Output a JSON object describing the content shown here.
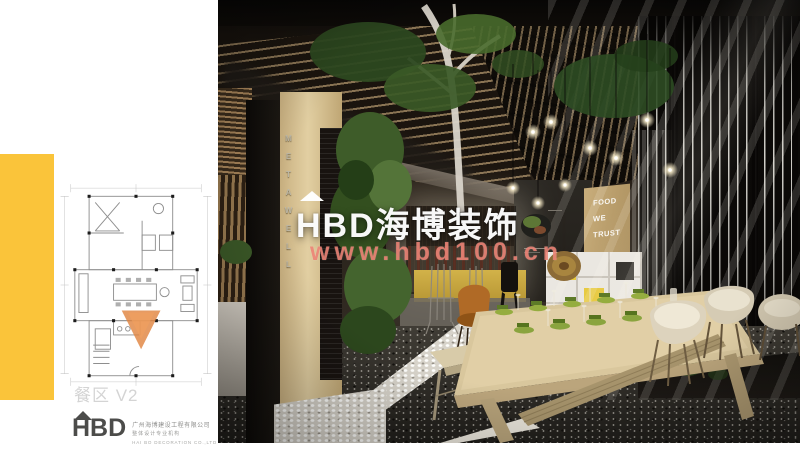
{
  "sidebar": {
    "plan_label": "餐区 V2",
    "accent_color": "#fac43a",
    "marker_color": "#e0823c"
  },
  "logo": {
    "brand": "HBD",
    "company_cn": "广州海博建设工程有限公司",
    "company_sub": "整体设计专业机构",
    "company_en": "HAI BO DECORATION CO.,LTD"
  },
  "watermark": {
    "brand": "HBD海博装饰",
    "url": "www.hbd100.cn",
    "brand_color": "#ffffff",
    "url_color": "#eb7d6e"
  },
  "render_signage": {
    "column_text": "METAWELL",
    "wall_text": "FOOD WE TRUST"
  }
}
